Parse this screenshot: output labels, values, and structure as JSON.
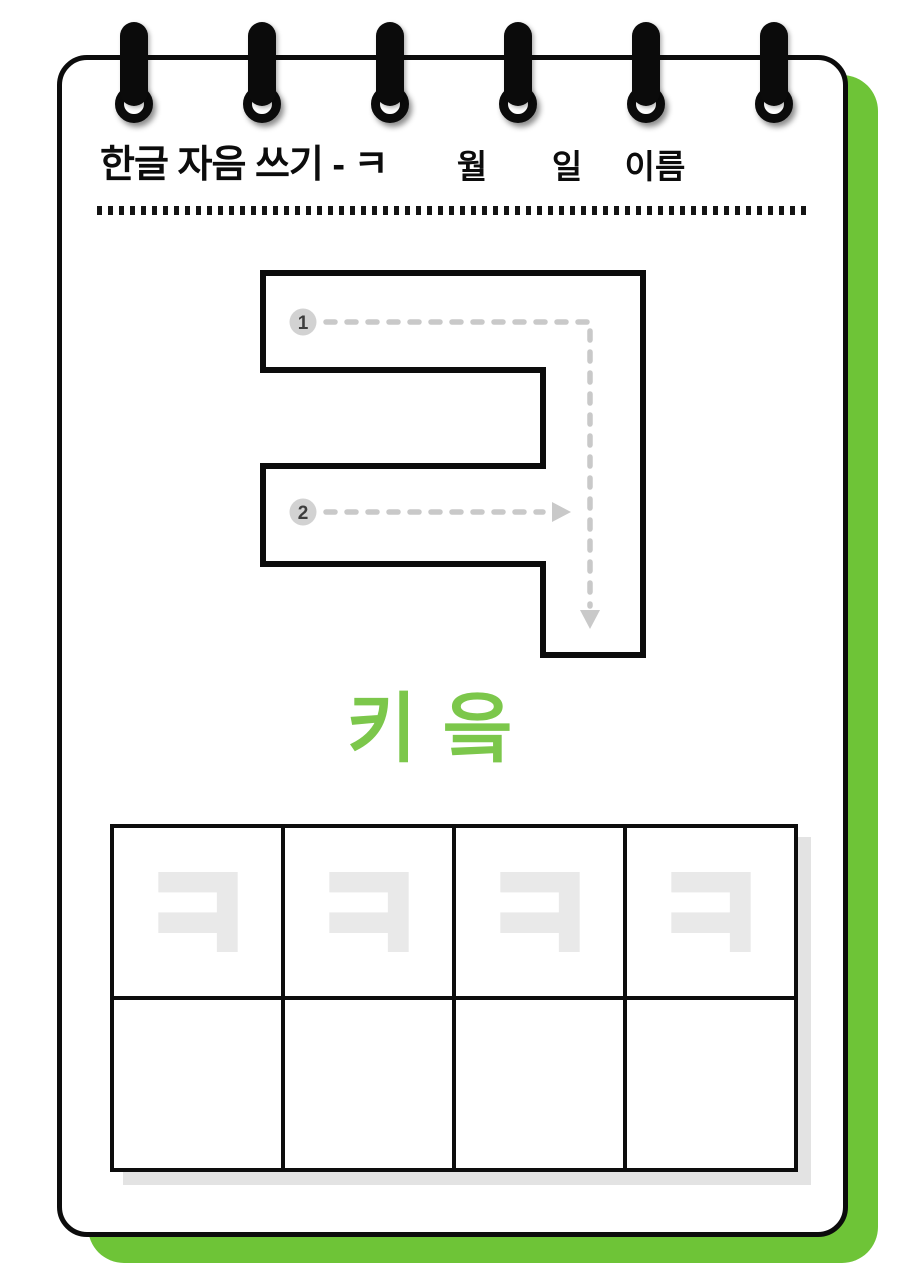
{
  "worksheet": {
    "title": "한글 자음 쓰기 - ㅋ",
    "target_letter": "ㅋ",
    "letter_name": "키읔",
    "header_fields": {
      "month_label": "월",
      "day_label": "일",
      "name_label": "이름"
    },
    "stroke_order": {
      "steps": [
        {
          "num": "1",
          "description": "top bar then down the right side"
        },
        {
          "num": "2",
          "description": "middle bar to the right"
        }
      ]
    },
    "practice_grid": {
      "rows": 2,
      "cols": 4,
      "trace_letter": "ㅋ",
      "trace_cells_count": 4,
      "empty_cells_count": 4
    }
  },
  "colors": {
    "ink": "#0c0c0c",
    "accent_green": "#6ec437",
    "letter_name_green": "#7cc74b",
    "trace_gray": "#e9e9e9",
    "guide_gray": "#c9c9c9",
    "step_circle_gray": "#d2d2d2",
    "grid_shadow_gray": "#e3e3e3"
  }
}
